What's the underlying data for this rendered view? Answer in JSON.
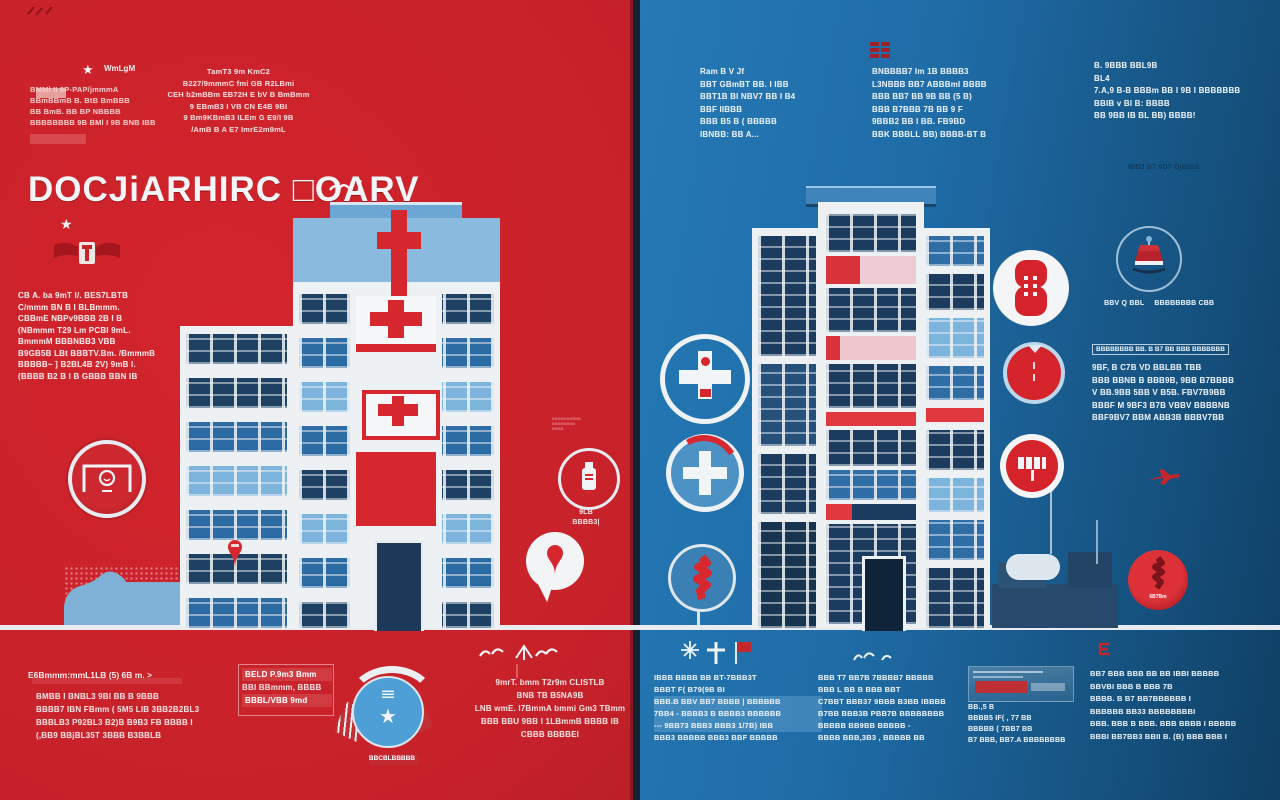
{
  "colors": {
    "left_bg": "#c32129",
    "right_bg": "#1f6ca7",
    "accent_red": "#d7272e",
    "navy": "#1b3c5e",
    "light_blue": "#7db4dc",
    "white": "#eef1f4",
    "pink": "#edccd3"
  },
  "left": {
    "top_left": {
      "star": "★",
      "tag": "WmLgM",
      "lines": [
        "BMMl II  9P-PAP/jmmmA",
        "BBmBBmB  B. BtB BmBBB",
        "BB BmB. BB   BP NBBBB",
        "BBBBBBBB 9B BMl I 9B  BNB IBB"
      ]
    },
    "top_center": {
      "lines": [
        "TamT3 9m KmC2",
        "B227/9mmmC fmi  GB R2LBmi",
        "CEH b2mBBm  EB72H E  bV B BmBmm",
        "9 EBmB3 I VB  CN E4B 9BI",
        "9 Bm9KBmB3  ILEm G E9/I 9B",
        "/AmB B A E7   ImrE2m9mL"
      ]
    },
    "title": "DOCJiARHIRC  □OARV",
    "title_star": "★",
    "intro": {
      "lines": [
        "CB A.  ba 9mT I/. BES7LBTB",
        "C/mmm  BN B I  BLBmmm.",
        "CBBmE  NBPv9BBB  2B I B",
        "(NBmmm  T29 Lm  PCBI  9mL.",
        "BmmmM  BBBNBB3  VBB",
        "B9GB5B  LBt BBBTV.Bm.  /BmmmB",
        "BBBBB~ ]  B2BL4B 2V) 9mB I.",
        "(BBBB  B2 B I   B GBBB  BBN IB"
      ]
    },
    "pill_note": {
      "micro": [
        "BBBBBBBBBB",
        "BBBBBBBB",
        "BBBB"
      ],
      "caption": [
        "9LB",
        "BBBB3|"
      ]
    },
    "bottom_a": {
      "heading": "E6Bmmm:mmL1LB (5) 6B m. >",
      "lines": [
        "BMBB I BNBL3   9BI  BB B  9BBB",
        "BBBB7 IBN  FBmm ( 5M5 LIB  3BB2B2BL3",
        "BBBLB3  P92BL3 B2)B  B9B3 FB  BBBB I",
        "(,BB9 BBjBL35T  3BBB  B3BBLB"
      ]
    },
    "bottom_b": {
      "lines": [
        {
          "t": "BELD P.9m3 Bmm",
          "cls": "boxed"
        },
        {
          "t": "BBI BBmmm, BBBB"
        },
        {
          "t": "BBBL/VBB 9md",
          "cls": "boxed"
        }
      ]
    },
    "badge_caption": "BBCBLBBBBB",
    "bottom_c": {
      "lines": [
        "9mrT. bmm T2r9m  CLISTLB",
        "BNB TB  B5NA9B",
        "LNB wmE. I7BmmA  bmmi  Gm3 TBmm",
        "BBB BBU 9BB  I  1LBmmB  BBBB  IB",
        "CBBB  BBBBEI"
      ]
    }
  },
  "right": {
    "top_a": {
      "lines": [
        "Ram    B V  Jf",
        "BBT GBmBT BB. I  IBB",
        "BBT1B  BI  NBV7 BB I B4",
        "BBF  IIBBB",
        "BBB  B5 B ( BBBBB",
        "IBNBB:  BB A..."
      ]
    },
    "top_b": {
      "lines": [
        "BNBBBB7 Im 1B  BBBB3",
        "L3NBBB  BB7    ABBBmI  BBBB",
        "BBB BB7  BB  9B  BB  (5 B)",
        "BBB  B7BBB  7B  BB 9 F",
        "9BBB2  BB I  BB.  FB9BD",
        "BBK  BBBLL  BB)  BBBB-BT B"
      ]
    },
    "top_c": {
      "lines": [
        "B. 9BBB  BBL9B",
        "BL4",
        "7.A,9 B-B  BBBm BB I  9B I BBBBBBB",
        "BBIB v BI  B: BBBB",
        "BB  9BB IB  BL  BB) BBBB!"
      ]
    },
    "caption_small": "IBB3 B7  6D7  OjBIBB",
    "lamp_caption_a": "BBV Q  BBL",
    "lamp_caption_b": "BBBBBBBB CBB",
    "panel": {
      "heading": "BBBBBBBB  BB. B  B7 BB  BBB  BBBBBBB",
      "lines": [
        "9BF, B C7B  VD  BBLBB  TBB",
        "BBB  BBNB  B  BBB9B,  9BB  B7BBBB",
        "V BB.9BB 5BB  V B5B.   FBV7B9BB",
        "BBBF  M 9BF3  B7B  VBBV   BBBBNB",
        "BBF9BV7  BBM ABB3B  BBBV7BB"
      ]
    },
    "red_badge_label": "6B7Bm",
    "bottom_a": {
      "lines": [
        "IBBB  BBBB  BB  BT-7BBB3T",
        "BBBT F(  B79(9B  BI",
        {
          "t": "BBB.B  BBV BB7 BBBB | BBBBBB",
          "cls": "hlblue"
        },
        {
          "t": "7BB4 - BBBB3  B BBBB3  BBBBBB",
          "cls": "hlblue"
        },
        {
          "t": "---  9BB73  BBB3 BBB3  1/7B)  IBB",
          "cls": "hlblue"
        },
        "BBB3  BBBBB      BBB3  BBF  BBBBB"
      ]
    },
    "bottom_b": {
      "lines": [
        "BBB T7 BB7B  7BBBB7 BBBBB",
        "BBB  L  BB  B  BBB BBT",
        "C7BBT BBB37  9BBB  B3BB  IBBBB",
        "B7BB  BBB3B  PBB7B  BBBBBBBB",
        "BBBBB  BB9BB  BBBBB  -",
        "BBBB  BBB,3B3 ,    BBBBB  BB"
      ]
    },
    "bottom_c": {
      "lines": [
        "BB.,5  B",
        "BBBB5 IF( ,  77 BB",
        "BBBBB ( 7BB7  BB",
        "B7 BBB, BB7.A BBBBBBBB"
      ]
    },
    "bottom_d": {
      "lines": [
        "BB7 BBB  BBB  BB  BB  IBBI  BBBBB",
        "BBVBI BBB  B  BBB 7B",
        "BBBB.  B B7 BB7BBBBBB I",
        "BBBBBB  BB33    BBBBBBBBI",
        "BBB. BBB B BBB. BBB  BBBB  I BBBBB",
        "BBBI  BB7BB3  BBII B.  (B) BBB BBB I"
      ]
    }
  }
}
